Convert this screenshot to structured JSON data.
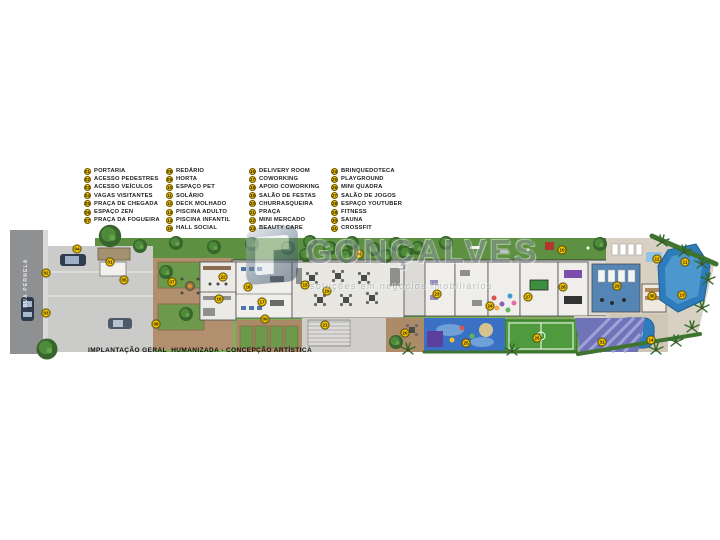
{
  "watermark": {
    "brand": "GONÇALVES",
    "tagline": "soluções em negócios imobiliários"
  },
  "caption": "IMPLANTAÇÃO GERAL  HUMANIZADA - CONCEPÇÃO ARTÍSTICA",
  "street": {
    "name": "RUA PERNELA"
  },
  "colors": {
    "badge_fill": "#f5c400",
    "badge_border": "#6b5a00",
    "grass": "#7fae5c",
    "grass_dark": "#5d9141",
    "street_gray": "#8f9092",
    "deck_brown": "#b2906f",
    "pool_blue": "#2e7cbb",
    "court_green": "#4f9a3c",
    "playground_blue": "#3a71c4",
    "floor_gray": "#dcdbd7"
  },
  "legend": {
    "columns": [
      {
        "items": [
          {
            "num": "01",
            "label": "PORTARIA"
          },
          {
            "num": "02",
            "label": "ACESSO PEDESTRES"
          },
          {
            "num": "03",
            "label": "ACESSO VEÍCULOS"
          },
          {
            "num": "04",
            "label": "VAGAS VISITANTES"
          },
          {
            "num": "05",
            "label": "PRAÇA DE CHEGADA"
          },
          {
            "num": "06",
            "label": "ESPAÇO ZEN"
          },
          {
            "num": "07",
            "label": "PRAÇA DA FOGUEIRA"
          }
        ]
      },
      {
        "items": [
          {
            "num": "08",
            "label": "REDÁRIO"
          },
          {
            "num": "09",
            "label": "HORTA"
          },
          {
            "num": "10",
            "label": "ESPAÇO PET"
          },
          {
            "num": "11",
            "label": "SOLÁRIO"
          },
          {
            "num": "12",
            "label": "DECK MOLHADO"
          },
          {
            "num": "13",
            "label": "PISCINA ADULTO"
          },
          {
            "num": "14",
            "label": "PISCINA INFANTIL"
          },
          {
            "num": "15",
            "label": "HALL SOCIAL"
          }
        ]
      },
      {
        "items": [
          {
            "num": "16",
            "label": "DELIVERY ROOM"
          },
          {
            "num": "17",
            "label": "COWORKING"
          },
          {
            "num": "18",
            "label": "APOIO COWORKING"
          },
          {
            "num": "19",
            "label": "SALÃO DE FESTAS"
          },
          {
            "num": "20",
            "label": "CHURRASQUEIRA"
          },
          {
            "num": "21",
            "label": "PRAÇA"
          },
          {
            "num": "22",
            "label": "MINI MERCADO"
          },
          {
            "num": "23",
            "label": "BEAUTY CARE"
          }
        ]
      },
      {
        "items": [
          {
            "num": "24",
            "label": "BRINQUEDOTECA"
          },
          {
            "num": "25",
            "label": "PLAYGROUND"
          },
          {
            "num": "26",
            "label": "MINI QUADRA"
          },
          {
            "num": "27",
            "label": "SALÃO DE JOGOS"
          },
          {
            "num": "28",
            "label": "ESPAÇO YOUTUBER"
          },
          {
            "num": "29",
            "label": "FITNESS"
          },
          {
            "num": "30",
            "label": "SAUNA"
          },
          {
            "num": "31",
            "label": "CROSSFIT"
          }
        ]
      }
    ]
  },
  "plan_badges": [
    {
      "num": "01",
      "x": 110,
      "y": 262
    },
    {
      "num": "02",
      "x": 46,
      "y": 273
    },
    {
      "num": "03",
      "x": 46,
      "y": 313
    },
    {
      "num": "04",
      "x": 77,
      "y": 249
    },
    {
      "num": "05",
      "x": 124,
      "y": 280
    },
    {
      "num": "06",
      "x": 359,
      "y": 254
    },
    {
      "num": "07",
      "x": 172,
      "y": 282
    },
    {
      "num": "08",
      "x": 156,
      "y": 324
    },
    {
      "num": "09",
      "x": 265,
      "y": 319
    },
    {
      "num": "10",
      "x": 562,
      "y": 250
    },
    {
      "num": "11",
      "x": 685,
      "y": 262
    },
    {
      "num": "12",
      "x": 657,
      "y": 259
    },
    {
      "num": "13",
      "x": 682,
      "y": 295
    },
    {
      "num": "14",
      "x": 651,
      "y": 340
    },
    {
      "num": "15",
      "x": 305,
      "y": 285
    },
    {
      "num": "16",
      "x": 219,
      "y": 299
    },
    {
      "num": "17",
      "x": 262,
      "y": 302
    },
    {
      "num": "18",
      "x": 248,
      "y": 287
    },
    {
      "num": "19",
      "x": 327,
      "y": 291
    },
    {
      "num": "20",
      "x": 405,
      "y": 333
    },
    {
      "num": "21",
      "x": 325,
      "y": 325
    },
    {
      "num": "22",
      "x": 223,
      "y": 277
    },
    {
      "num": "23",
      "x": 437,
      "y": 294
    },
    {
      "num": "24",
      "x": 490,
      "y": 306
    },
    {
      "num": "25",
      "x": 466,
      "y": 343
    },
    {
      "num": "26",
      "x": 537,
      "y": 338
    },
    {
      "num": "27",
      "x": 528,
      "y": 297
    },
    {
      "num": "28",
      "x": 563,
      "y": 287
    },
    {
      "num": "29",
      "x": 617,
      "y": 286
    },
    {
      "num": "30",
      "x": 652,
      "y": 296
    },
    {
      "num": "31",
      "x": 602,
      "y": 342
    }
  ]
}
